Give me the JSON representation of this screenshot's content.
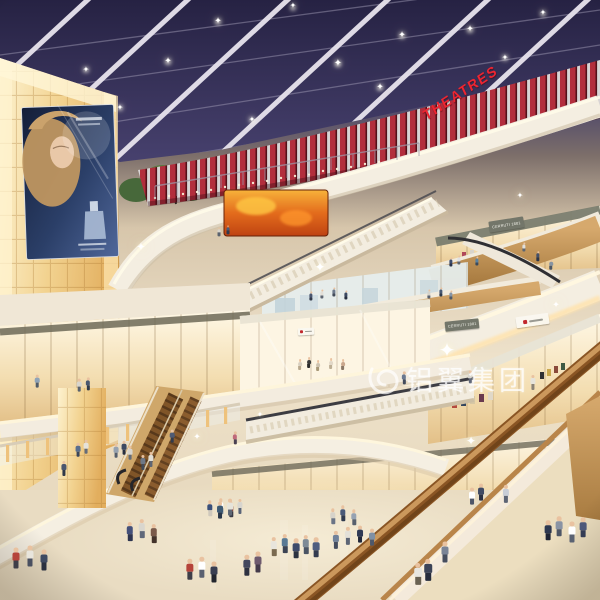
{
  "signs": {
    "theatres": "THEATRES",
    "shop_upper": "CERRUTI 1881",
    "shop_lower": "CERRUTI 1881"
  },
  "watermark": {
    "text": "铝翼集团",
    "logo": "swirl-logo"
  },
  "icons": {
    "sparkle_glyph": "✦"
  },
  "palette": {
    "skylight": "#2d2948",
    "beam": "#e6e2ec",
    "theatre_red": "#b22e3c",
    "sign_red": "#ee2531",
    "wood": "#b98a4e",
    "fascia_cream": "#f3ecdf",
    "cove_glow": "#ffe9bd",
    "wall_glow": "#f2d28f",
    "floor": "#e9dcc2",
    "led_orange": "#e0681c",
    "billboard_blue": "#22345c",
    "watermark_white": "#ffffff"
  },
  "figures": [
    [
      219,
      236,
      0.55,
      "#d8d5cd",
      "#5a626e"
    ],
    [
      228,
      234,
      0.55,
      "#485878",
      "#2f3a50"
    ],
    [
      524,
      252,
      0.6,
      "#e0dfda",
      "#5e6670"
    ],
    [
      538,
      261,
      0.62,
      "#44506a",
      "#2c3446"
    ],
    [
      551,
      270,
      0.65,
      "#8794a2",
      "#4c5664"
    ],
    [
      451,
      267,
      0.6,
      "#3c4c6e",
      "#28324a"
    ],
    [
      459,
      265,
      0.6,
      "#dfe0e2",
      "#5c646e"
    ],
    [
      477,
      266,
      0.6,
      "#5a82a0",
      "#3a4a5c"
    ],
    [
      311,
      301,
      0.6,
      "#4a5670",
      "#303848"
    ],
    [
      322,
      299,
      0.6,
      "#e2dfd8",
      "#5e6672"
    ],
    [
      334,
      297,
      0.6,
      "#6e7a8c",
      "#444c5a"
    ],
    [
      346,
      300,
      0.6,
      "#3c4860",
      "#272e3e"
    ],
    [
      429,
      299,
      0.6,
      "#d5d2ca",
      "#5a6270"
    ],
    [
      441,
      297,
      0.6,
      "#495a74",
      "#2f3a4a"
    ],
    [
      451,
      300,
      0.6,
      "#8795a5",
      "#4d5866"
    ],
    [
      37,
      388,
      0.85,
      "#8fa4b8",
      "#515c68"
    ],
    [
      79,
      392,
      0.85,
      "#d8d5cd",
      "#5a626e"
    ],
    [
      88,
      390,
      0.8,
      "#4a5870",
      "#303a4a"
    ],
    [
      300,
      370,
      0.7,
      "#d8cfc0",
      "#b8a88e"
    ],
    [
      309,
      368,
      0.7,
      "#3a3a3a",
      "#2a2a2a"
    ],
    [
      318,
      371,
      0.7,
      "#cfc4b2",
      "#a89878"
    ],
    [
      331,
      369,
      0.7,
      "#e2d8c8",
      "#bcae94"
    ],
    [
      343,
      370,
      0.7,
      "#caa88e",
      "#8a7866"
    ],
    [
      404,
      384,
      0.8,
      "#6a7890",
      "#414a5c"
    ],
    [
      470,
      383,
      0.8,
      "#d9d6ce",
      "#5e6678"
    ],
    [
      533,
      390,
      0.95,
      "#e6e3da",
      "#8a8276"
    ],
    [
      235,
      444,
      0.8,
      "#c06a7a",
      "#4a4152"
    ],
    [
      78,
      457,
      0.9,
      "#5a6f8e",
      "#3a465a"
    ],
    [
      86,
      454,
      0.9,
      "#e5e2da",
      "#646c7a"
    ],
    [
      64,
      476,
      0.95,
      "#4a566e",
      "#303848"
    ],
    [
      116,
      458,
      0.9,
      "#97a2b0",
      "#555e6c"
    ],
    [
      124,
      455,
      0.9,
      "#3d4962",
      "#282f40"
    ],
    [
      130,
      460,
      0.9,
      "#d8d4cc",
      "#636b78"
    ],
    [
      143,
      470,
      0.95,
      "#6e7886",
      "#434b58"
    ],
    [
      151,
      467,
      0.95,
      "#e2dfd6",
      "#5e6674"
    ],
    [
      172,
      443,
      0.85,
      "#4e5a74",
      "#333b4c"
    ],
    [
      210,
      516,
      1.0,
      "#3a4f7a",
      "#cfc8bc"
    ],
    [
      221,
      514,
      1.0,
      "#ffffff",
      "#6b7a8c"
    ],
    [
      231,
      517,
      1.0,
      "#8a4a42",
      "#3a3a44"
    ],
    [
      240,
      514,
      0.95,
      "#d8d5ce",
      "#5a6478"
    ],
    [
      274,
      556,
      1.2,
      "#e8e5dc",
      "#7a6a50"
    ],
    [
      285,
      553,
      1.2,
      "#5a7a94",
      "#3c4454"
    ],
    [
      296,
      558,
      1.25,
      "#3e4a6a",
      "#2c3240"
    ],
    [
      306,
      554,
      1.2,
      "#7d8a96",
      "#4a5464"
    ],
    [
      316,
      557,
      1.25,
      "#4f5d80",
      "#343c50"
    ],
    [
      247,
      576,
      1.35,
      "#44485e",
      "#2e3140"
    ],
    [
      258,
      572,
      1.3,
      "#6e5a6e",
      "#443a4a"
    ],
    [
      190,
      580,
      1.35,
      "#b5433a",
      "#3e3e48"
    ],
    [
      202,
      578,
      1.35,
      "#ffffff",
      "#5a6070"
    ],
    [
      214,
      582,
      1.3,
      "#3a3f52",
      "#23262f"
    ],
    [
      336,
      549,
      1.15,
      "#70819a",
      "#454d5e"
    ],
    [
      348,
      545,
      1.15,
      "#e3e0d8",
      "#5d6575"
    ],
    [
      360,
      543,
      1.1,
      "#2f3a55",
      "#20273a"
    ],
    [
      372,
      546,
      1.1,
      "#8090a4",
      "#4e586a"
    ],
    [
      333,
      524,
      1.0,
      "#d7d3ca",
      "#6a7486"
    ],
    [
      343,
      521,
      1.0,
      "#4a5a78",
      "#303a4e"
    ],
    [
      354,
      525,
      1.0,
      "#96a2b2",
      "#57606e"
    ],
    [
      130,
      541,
      1.2,
      "#44507a",
      "#2d3450"
    ],
    [
      142,
      538,
      1.2,
      "#d9d6ce",
      "#60687a"
    ],
    [
      154,
      543,
      1.2,
      "#7a5a4a",
      "#43322a"
    ],
    [
      220,
      519,
      1.1,
      "#3e5a74",
      "#2a3648"
    ],
    [
      230,
      516,
      1.1,
      "#e6e3da",
      "#5f6775"
    ],
    [
      16,
      568,
      1.3,
      "#b5433a",
      "#3e3e48"
    ],
    [
      30,
      566,
      1.3,
      "#e8e5dc",
      "#4a5060"
    ],
    [
      44,
      570,
      1.3,
      "#3f4a62",
      "#2a3040"
    ],
    [
      472,
      505,
      1.1,
      "#ffffff",
      "#4e5668"
    ],
    [
      481,
      501,
      1.1,
      "#404a64",
      "#2a3044"
    ],
    [
      506,
      503,
      1.15,
      "#c8cdd6",
      "#5c6474"
    ],
    [
      548,
      540,
      1.25,
      "#2e3850",
      "#1f2434"
    ],
    [
      559,
      536,
      1.25,
      "#8a94a4",
      "#4e5666"
    ],
    [
      572,
      542,
      1.3,
      "#ffffff",
      "#5a6272"
    ],
    [
      583,
      537,
      1.25,
      "#4e587a",
      "#343c54"
    ],
    [
      418,
      585,
      1.4,
      "#e8e6df",
      "#6a6252"
    ],
    [
      428,
      581,
      1.4,
      "#3c4458",
      "#262c3c"
    ],
    [
      445,
      562,
      1.3,
      "#7a8496",
      "#464e5e"
    ]
  ],
  "sparkles": [
    [
      447,
      350,
      20
    ],
    [
      320,
      268,
      13
    ],
    [
      141,
      247,
      11
    ],
    [
      471,
      441,
      12
    ],
    [
      197,
      438,
      9
    ],
    [
      556,
      306,
      9
    ],
    [
      260,
      415,
      8
    ],
    [
      520,
      196,
      8
    ],
    [
      218,
      22,
      9
    ],
    [
      168,
      62,
      9
    ],
    [
      338,
      64,
      10
    ],
    [
      402,
      36,
      9
    ],
    [
      293,
      6,
      8
    ],
    [
      470,
      30,
      9
    ],
    [
      543,
      13,
      8
    ],
    [
      252,
      120,
      8
    ],
    [
      380,
      88,
      9
    ],
    [
      120,
      108,
      8
    ],
    [
      86,
      70,
      8
    ],
    [
      505,
      58,
      8
    ]
  ]
}
